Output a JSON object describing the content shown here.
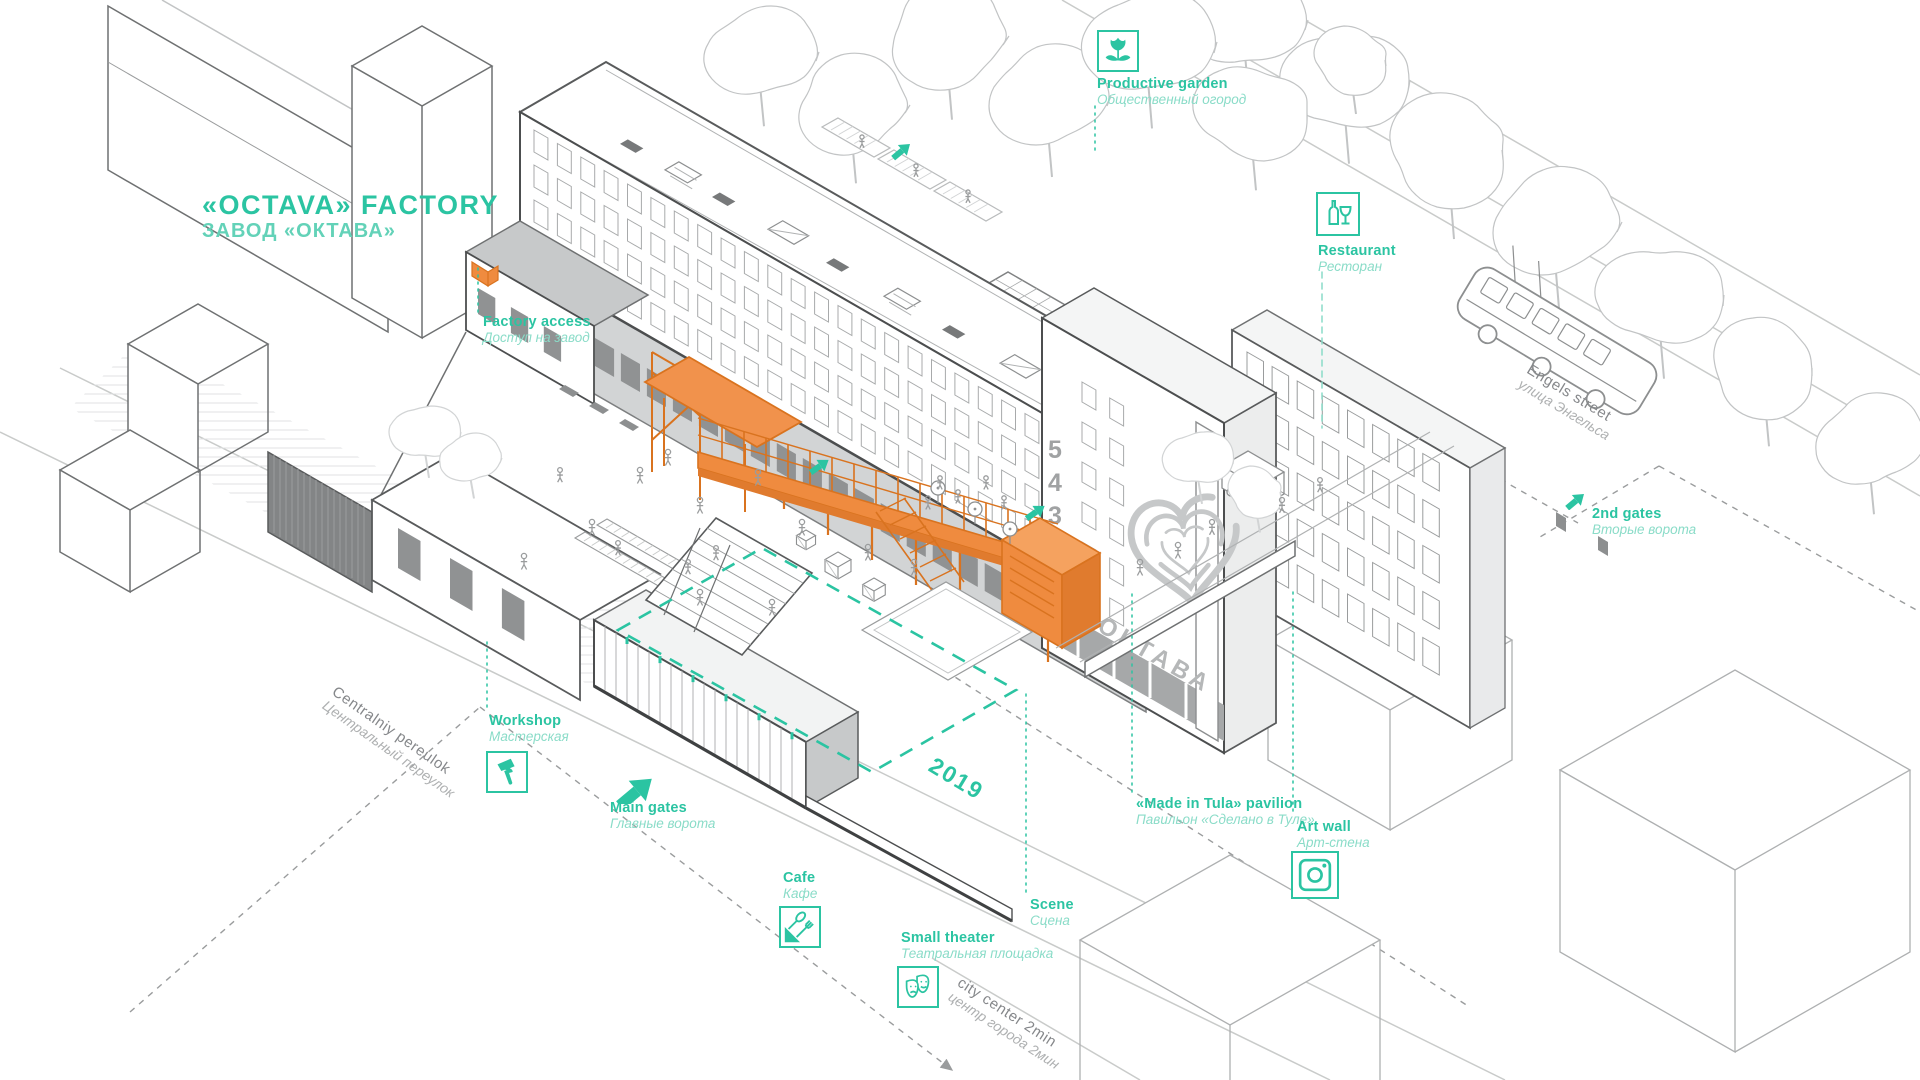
{
  "title": {
    "en": "«OCTAVA» FACTORY",
    "ru": "ЗАВОД «ОКТАВА»"
  },
  "poi": [
    {
      "id": "factory-access",
      "en": "Factory access",
      "ru": "Доступ на завод",
      "icon": "none"
    },
    {
      "id": "productive-garden",
      "en": "Productive garden",
      "ru": "Общественный огород",
      "icon": "flower-icon"
    },
    {
      "id": "restaurant",
      "en": "Restaurant",
      "ru": "Ресторан",
      "icon": "wine-icon"
    },
    {
      "id": "second-gates",
      "en": "2nd gates",
      "ru": "Вторые ворота",
      "icon": "arrow-icon"
    },
    {
      "id": "workshop",
      "en": "Workshop",
      "ru": "Мастерская",
      "icon": "hammer-icon"
    },
    {
      "id": "main-gates",
      "en": "Main gates",
      "ru": "Главные ворота",
      "icon": "arrow-icon"
    },
    {
      "id": "cafe",
      "en": "Cafe",
      "ru": "Кафе",
      "icon": "cutlery-icon"
    },
    {
      "id": "small-theater",
      "en": "Small theater",
      "ru": "Театральная площадка",
      "icon": "theater-masks-icon"
    },
    {
      "id": "scene",
      "en": "Scene",
      "ru": "Сцена",
      "icon": "none"
    },
    {
      "id": "made-in-tula",
      "en": "«Made in Tula» pavilion",
      "ru": "Павильон «Сделано в Туле»",
      "icon": "none"
    },
    {
      "id": "art-wall",
      "en": "Art wall",
      "ru": "Арт-стена",
      "icon": "camera-icon"
    }
  ],
  "streets": [
    {
      "id": "engels-street",
      "en": "Engels street",
      "ru": "улица Энгельса"
    },
    {
      "id": "centralniy-pereulok",
      "en": "Centralniy pereulok",
      "ru": "Центральный переулок"
    },
    {
      "id": "city-center",
      "en": "city center 2min",
      "ru": "центр города 2мин"
    }
  ],
  "zone": {
    "year": "2019"
  },
  "tower": {
    "floors": [
      "5",
      "4",
      "3",
      "2",
      "1"
    ],
    "logo": "ОКТАВА"
  },
  "colors": {
    "accent": "#2BC4A2",
    "accent_light": "#8ADCC8",
    "orange": "#EF8B3F",
    "orange_dark": "#D9731F",
    "line_dark": "#4C4E4F",
    "line_mid": "#8D8F90",
    "line_light": "#C2C4C5"
  }
}
